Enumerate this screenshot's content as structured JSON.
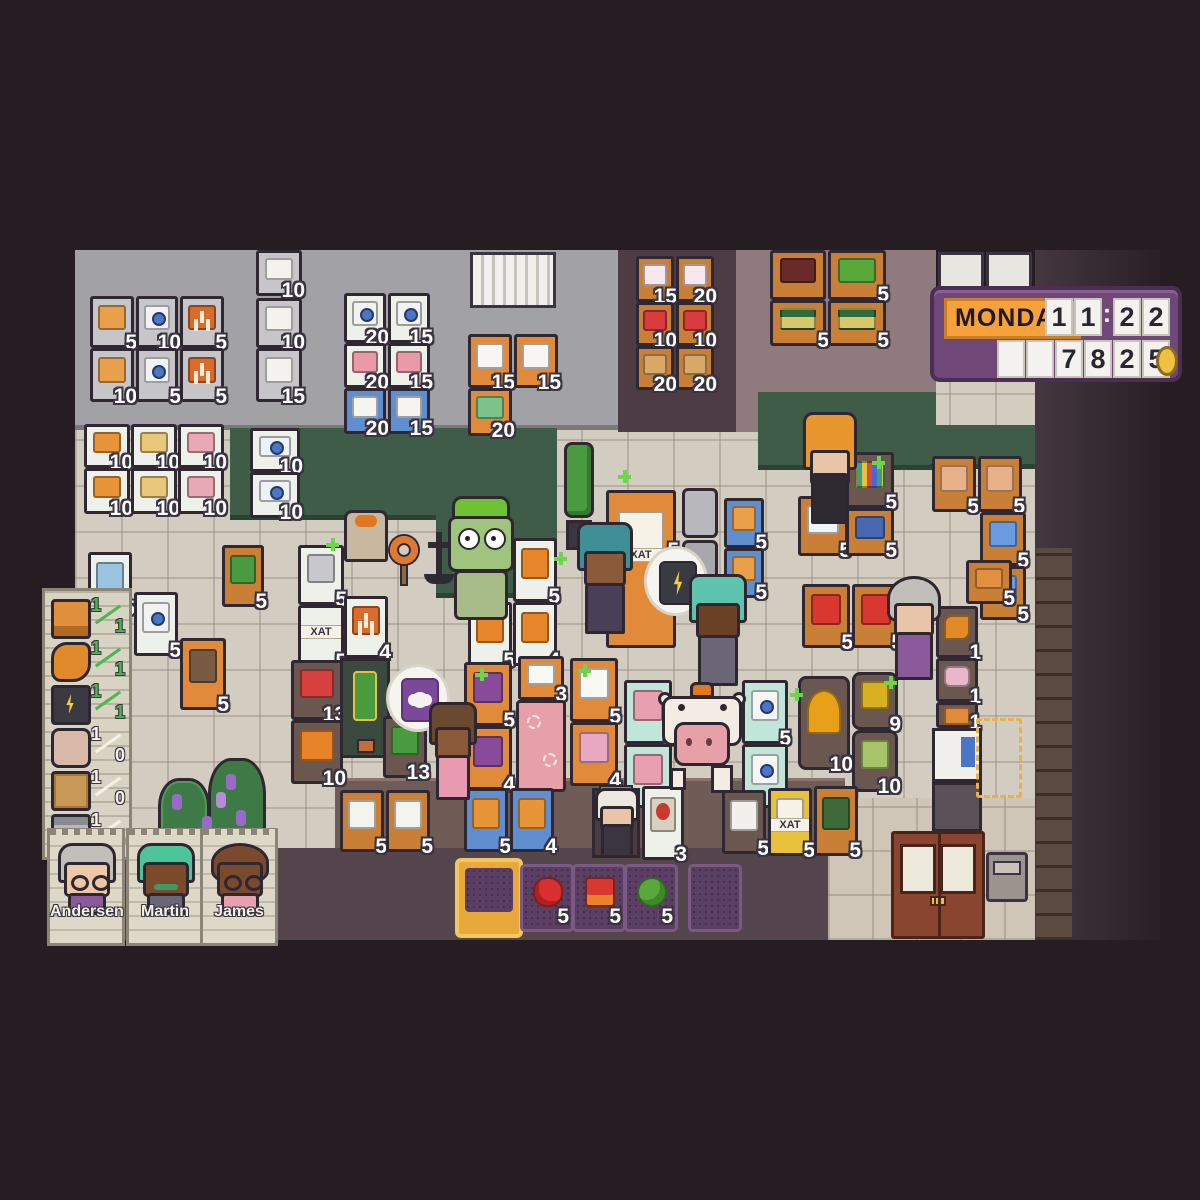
{
  "colors": {
    "background": "#251d21",
    "floor": "#d3ccc0",
    "gray_wall": "#a2a2a6",
    "green_wall": "#3f5c49",
    "corridor_wall": "#8f7b7e",
    "hud_frame": "#6f4878",
    "hud_accent_orange": "#f5a23c",
    "digit_cell": "#f4f2ee",
    "hotbar_slot_purple": "#5a3f63",
    "hotbar_selected_yellow": "#e8a83c",
    "badge_text": "#ffffff",
    "badge_outline": "#3a3340",
    "checklist_paper": "#d8d3c2",
    "done_green": "#4ab84e",
    "coin_gold": "#f0c040",
    "placement_dash_yellow": "#e8b24a"
  },
  "hud": {
    "day": "MONDAY",
    "time": "11:22",
    "time_digits": {
      "h1": "1",
      "h2": "1",
      "sep": ":",
      "m1": "2",
      "m2": "2"
    },
    "money": "7825",
    "money_digits": {
      "d1": "7",
      "d2": "8",
      "d3": "2",
      "d4": "5"
    },
    "coin_icon": "coin-icon"
  },
  "checklist": {
    "items": [
      {
        "icon": "crate-icon",
        "num": "1",
        "den": "1",
        "done": true
      },
      {
        "icon": "cheese-puff-icon",
        "num": "1",
        "den": "1",
        "done": true
      },
      {
        "icon": "battery-icon",
        "num": "1",
        "den": "1",
        "done": true
      },
      {
        "icon": "bottle-icon",
        "num": "1",
        "den": "0",
        "done": false
      },
      {
        "icon": "bread-bundle-icon",
        "num": "1",
        "den": "0",
        "done": false
      },
      {
        "icon": "appliance-icon",
        "num": "1",
        "den": "0",
        "done": false
      }
    ]
  },
  "portraits": [
    {
      "name": "Andersen"
    },
    {
      "name": "Martin"
    },
    {
      "name": "James"
    }
  ],
  "hotbar": {
    "slots": [
      {
        "item": "",
        "count": "",
        "selected": true
      },
      {
        "item": "apple",
        "count": "5",
        "selected": false
      },
      {
        "item": "soda-box",
        "count": "5",
        "selected": false
      },
      {
        "item": "cabbage",
        "count": "5",
        "selected": false
      },
      {
        "item": "",
        "count": "",
        "selected": false
      }
    ]
  },
  "labels": {
    "vending_brand": "XAT"
  },
  "characters": {
    "zombie": "zombie-statue",
    "teal_hair": "teal-haired-customer",
    "teal_hood": "hooded-customer",
    "cow": "cow-customer",
    "blonde": "blonde-worker",
    "old_lady": "elderly-customer",
    "brown_hair": "pink-shirt-customer",
    "nun": "nun-customer",
    "thought_battery": "battery",
    "thought_flower": "flower-item"
  },
  "shelves": {
    "w1": {
      "item": "wall-food-machine",
      "count": "5"
    },
    "w2": {
      "item": "wall-washer-machine",
      "count": "10"
    },
    "w3": {
      "item": "grave-poster",
      "count": "5"
    },
    "w4": {
      "item": "wall-food-machine",
      "count": "10"
    },
    "w5": {
      "item": "wall-washer-machine",
      "count": "5"
    },
    "w6": {
      "item": "grave-poster",
      "count": "5"
    },
    "w7": {
      "item": "ghost-machine",
      "count": "10"
    },
    "w8": {
      "item": "ghost-machine",
      "count": "10"
    },
    "w9": {
      "item": "ghost-machine",
      "count": "15"
    },
    "f1": {
      "item": "orange-fridge",
      "count": "10"
    },
    "f2": {
      "item": "orange-fridge",
      "count": "10"
    },
    "f3": {
      "item": "snack-fridge",
      "count": "10"
    },
    "f4": {
      "item": "snack-fridge",
      "count": "10"
    },
    "f5": {
      "item": "meat-fridge",
      "count": "10"
    },
    "f6": {
      "item": "meat-fridge",
      "count": "10"
    },
    "f7": {
      "item": "dairy-fridge",
      "count": "10"
    },
    "f8": {
      "item": "dairy-fridge",
      "count": "10"
    },
    "m1": {
      "item": "washing-machine",
      "count": "20"
    },
    "m2": {
      "item": "washing-machine",
      "count": "15"
    },
    "m3": {
      "item": "raw-meat",
      "count": "20"
    },
    "m4": {
      "item": "raw-meat",
      "count": "15"
    },
    "m5": {
      "item": "detergent-box",
      "count": "20"
    },
    "m6": {
      "item": "detergent-box",
      "count": "15"
    },
    "t1": {
      "item": "toilet",
      "count": "15"
    },
    "t2": {
      "item": "toilet",
      "count": "15"
    },
    "t3": {
      "item": "trash-can",
      "count": "20"
    },
    "b1": {
      "item": "cake",
      "count": "15"
    },
    "b2": {
      "item": "cake",
      "count": "20"
    },
    "b3": {
      "item": "strawberries",
      "count": "10"
    },
    "b4": {
      "item": "strawberries",
      "count": "10"
    },
    "b5": {
      "item": "bread",
      "count": "20"
    },
    "b6": {
      "item": "bread",
      "count": "20"
    },
    "p1": {
      "item": "empty-crate",
      "count": ""
    },
    "p2": {
      "item": "cabbage",
      "count": "5"
    },
    "p3": {
      "item": "seed-bag",
      "count": "5"
    },
    "p4": {
      "item": "seed-bag",
      "count": "5"
    },
    "pp1": {
      "item": "potted-plant",
      "count": "5"
    },
    "lf1": {
      "item": "poster-machine",
      "count": "5"
    },
    "lf2": {
      "item": "washer-display",
      "count": "5"
    },
    "lf3": {
      "item": "snack-machine",
      "count": "5"
    },
    "g1": {
      "item": "watering-can",
      "count": "5"
    },
    "g2": {
      "item": "grave-poster",
      "count": "4"
    },
    "g3": {
      "item": "vending-xat",
      "count": "5"
    },
    "c1": {
      "item": "cheese-snacks",
      "count": "5"
    },
    "c2": {
      "item": "cheese-snacks",
      "count": "5"
    },
    "c3": {
      "item": "cheese-snacks",
      "count": "4"
    },
    "v1": {
      "item": "vending-xat",
      "count": "5"
    },
    "v2": {
      "item": "burger-vending",
      "count": "5"
    },
    "v3": {
      "item": "burger-vending",
      "count": "5"
    },
    "cl1": {
      "item": "water-bottles",
      "count": "5"
    },
    "cl2": {
      "item": "clothes-rack",
      "count": "5"
    },
    "cl3": {
      "item": "jeans",
      "count": "5"
    },
    "ch1": {
      "item": "armchair",
      "count": "5"
    },
    "ch2": {
      "item": "armchair",
      "count": "5"
    },
    "ch3": {
      "item": "blue-door",
      "count": "5"
    },
    "ch4": {
      "item": "blue-door",
      "count": "5"
    },
    "sd1": {
      "item": "soda-boxes",
      "count": "5"
    },
    "sd2": {
      "item": "soda-boxes",
      "count": "5"
    },
    "br1": {
      "item": "honey-barrel",
      "count": "10"
    },
    "br2": {
      "item": "mustard-barrel",
      "count": "9"
    },
    "br3": {
      "item": "barrel",
      "count": "10"
    },
    "rc1": {
      "item": "cheese-wheel",
      "count": "1"
    },
    "rc2": {
      "item": "lotion-bottle",
      "count": "1"
    },
    "rc3": {
      "item": "orange-box",
      "count": "1"
    },
    "rc4": {
      "item": "crate-table",
      "count": "5"
    },
    "mf1": {
      "item": "meat-cooler",
      "count": "5"
    },
    "mf2": {
      "item": "meat-cooler",
      "count": "5"
    },
    "mf3": {
      "item": "dairy-cooler",
      "count": "5"
    },
    "mf4": {
      "item": "dairy-cooler",
      "count": "5"
    },
    "pr1": {
      "item": "tomatoes",
      "count": "13"
    },
    "pr2": {
      "item": "carrots",
      "count": "10"
    },
    "pr3": {
      "item": "potted-plant",
      "count": "13"
    },
    "hy1": {
      "item": "cotton-pads",
      "count": "5"
    },
    "hy2": {
      "item": "cotton-pads",
      "count": "4"
    },
    "hy3": {
      "item": "toilet-paper",
      "count": "3"
    },
    "hy4": {
      "item": "toilet-paper",
      "count": "5"
    },
    "hy5": {
      "item": "tissues",
      "count": "4"
    },
    "bt1": {
      "item": "milk-bottles",
      "count": "5"
    },
    "bt2": {
      "item": "milk-bottles",
      "count": "5"
    },
    "bt3": {
      "item": "snack-display",
      "count": "5"
    },
    "bt4": {
      "item": "snack-display",
      "count": "4"
    },
    "kk1": {
      "item": "magazine-stand",
      "count": "3"
    },
    "kk2": {
      "item": "ticket-machine",
      "count": "5"
    },
    "kk3": {
      "item": "vending-xat",
      "count": "5"
    },
    "kk4": {
      "item": "pickle-barrel",
      "count": "5"
    }
  }
}
